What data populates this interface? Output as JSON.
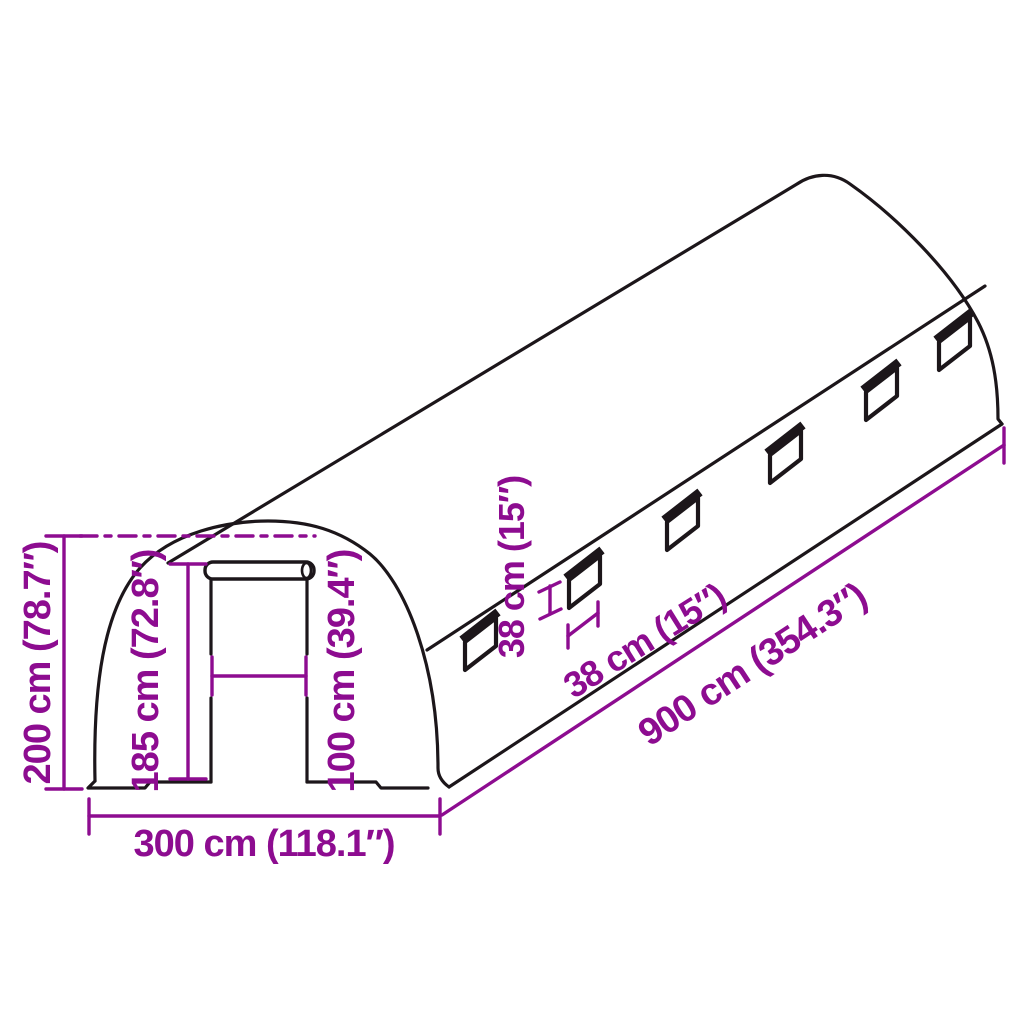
{
  "figure": {
    "subject": "polytunnel-greenhouse-dimension-diagram",
    "windows": {
      "count": 6
    }
  },
  "colors": {
    "dimension": "#8d0c90",
    "outline": "#1c161a",
    "background": "#ffffff"
  },
  "labels": {
    "height_total": "200 cm (78.7″)",
    "door_height": "185 cm (72.8″)",
    "door_width": "100 cm (39.4″)",
    "width_total": "300 cm (118.1″)",
    "length_total": "900 cm (354.3″)",
    "window_height": "38 cm (15″)",
    "window_width": "38 cm (15″)"
  }
}
